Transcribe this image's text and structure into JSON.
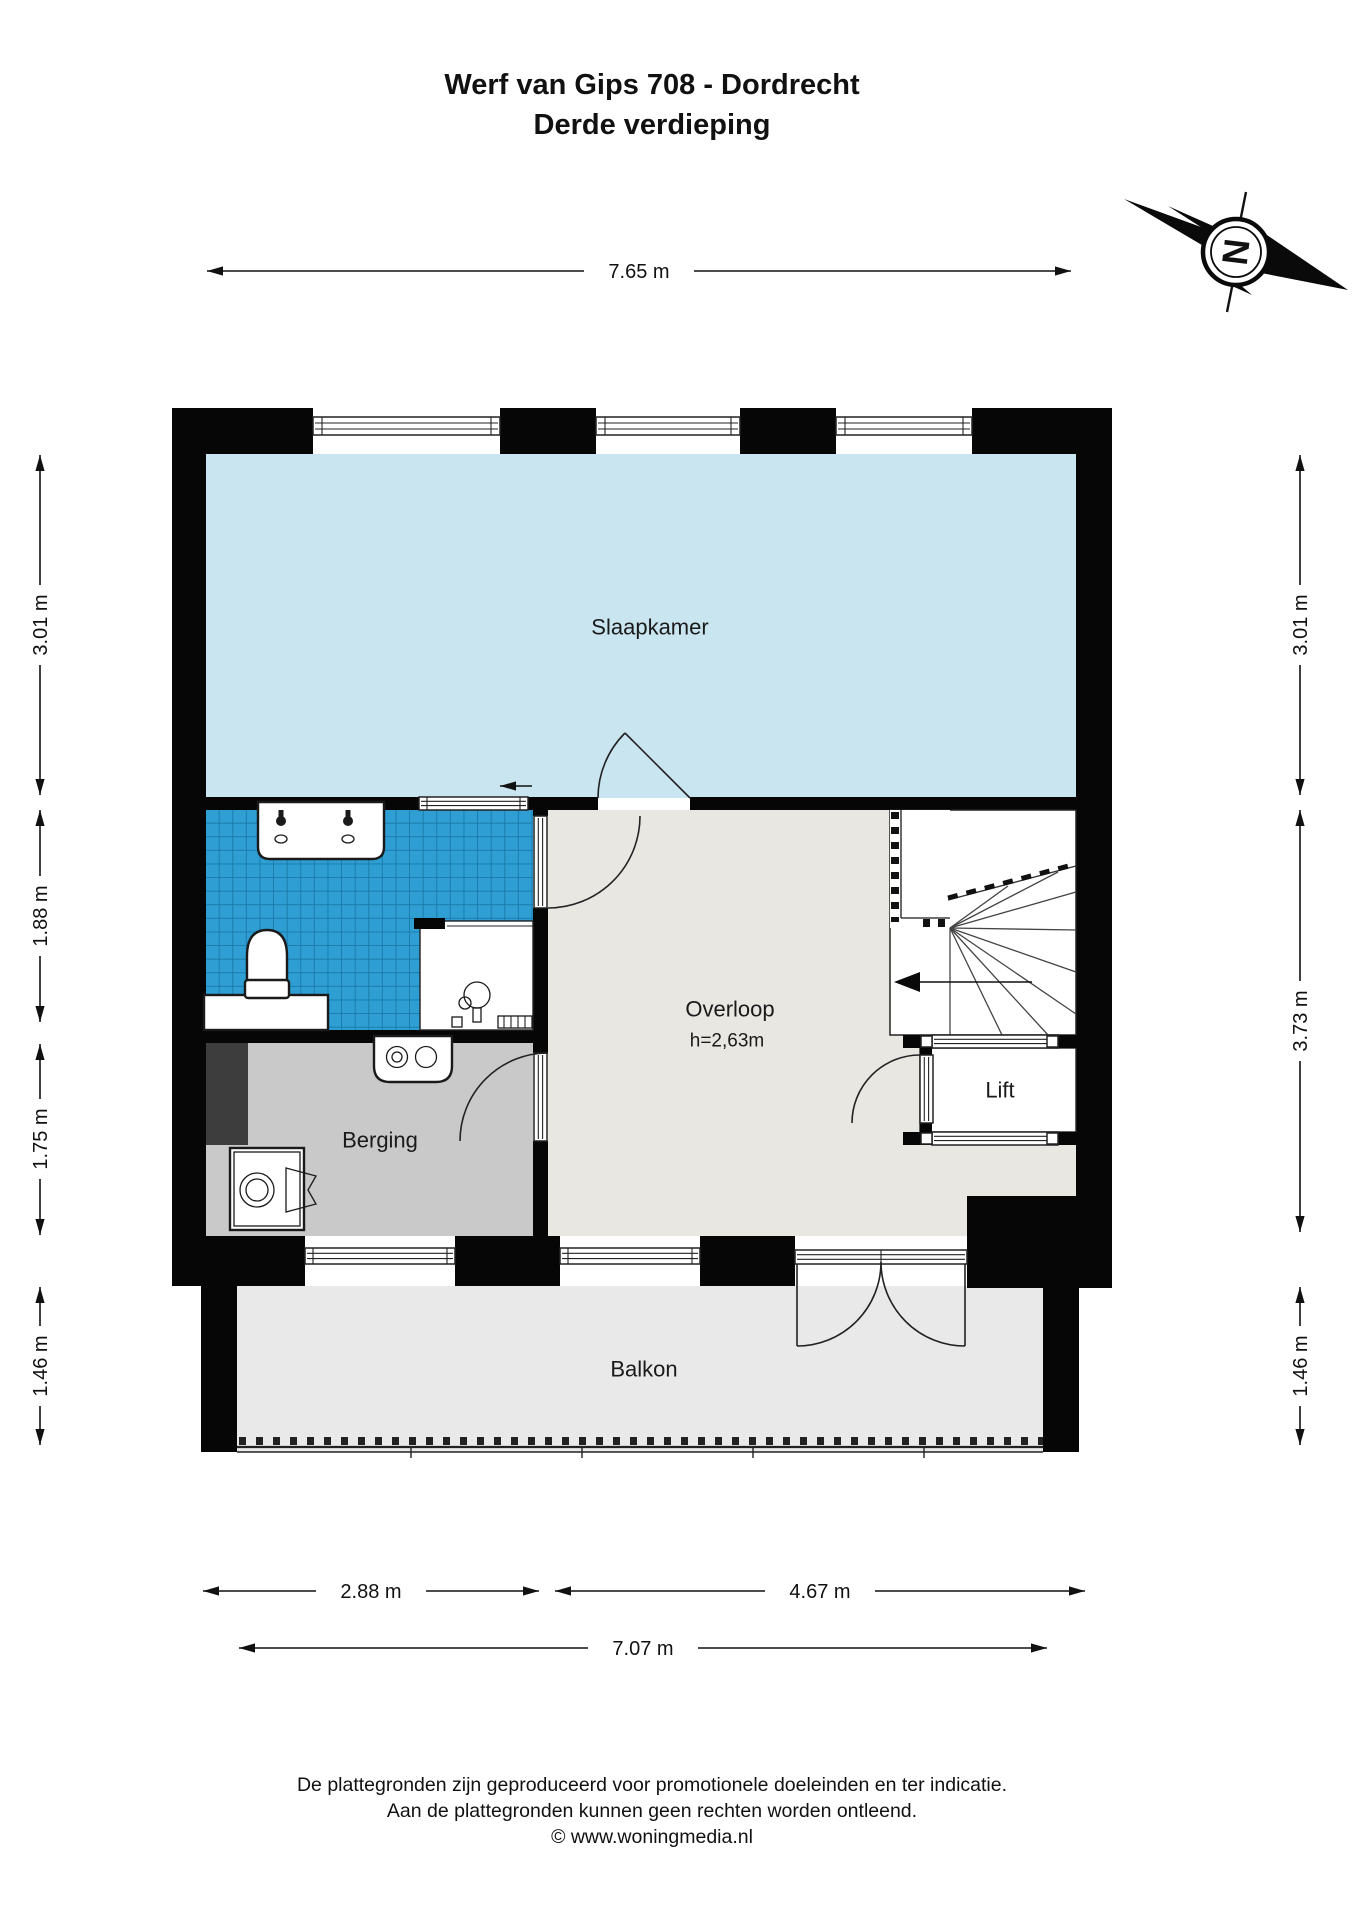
{
  "title": {
    "line1": "Werf van Gips 708 - Dordrecht",
    "line2": "Derde verdieping"
  },
  "compass": {
    "north_label": "N"
  },
  "dimensions": {
    "top": "7.65 m",
    "left": [
      "3.01 m",
      "1.88 m",
      "1.75 m",
      "1.46 m"
    ],
    "right": [
      "3.01 m",
      "3.73 m",
      "1.46 m"
    ],
    "bottom_row1": [
      "2.88 m",
      "4.67 m"
    ],
    "bottom_row2": "7.07 m"
  },
  "rooms": {
    "slaapkamer": "Slaapkamer",
    "overloop": "Overloop",
    "overloop_height": "h=2,63m",
    "lift": "Lift",
    "berging": "Berging",
    "balkon": "Balkon"
  },
  "footer": {
    "line1": "De plattegronden zijn geproduceerd voor promotionele doeleinden en ter indicatie.",
    "line2": "Aan de plattegronden kunnen geen rechten worden ontleend.",
    "line3": "© www.woningmedia.nl"
  },
  "colors": {
    "slaapkamer_floor": "#c9e5f0",
    "tile_base": "#2E9ED3",
    "tile_grout": "#1878A8",
    "overloop_floor": "#e8e7e2",
    "berging_floor": "#c9c9c9",
    "balkon_floor": "#e9e9e9",
    "duct": "#3d3d3d",
    "wall": "#060606"
  }
}
